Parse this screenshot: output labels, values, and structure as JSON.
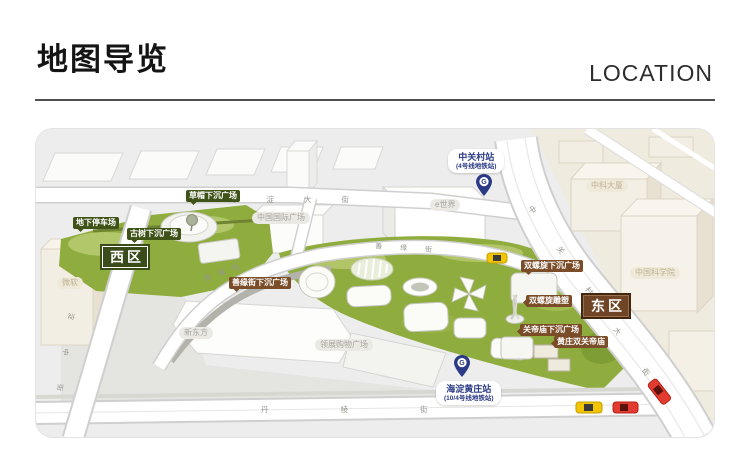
{
  "header": {
    "title_cn": "地图导览",
    "title_en": "LOCATION"
  },
  "map": {
    "zones": {
      "west": "西区",
      "east": "东区"
    },
    "green_labels": {
      "underground_parking": "地下停车场",
      "ancient_tree_plaza": "古树下沉广场",
      "straw_hat_plaza": "草帽下沉广场"
    },
    "brown_labels": {
      "shanyuan_street_plaza": "善缘街下沉广场",
      "double_helix_plaza": "双螺旋下沉广场",
      "double_helix_sculpture": "双螺旋雕塑",
      "guandi_temple_plaza": "关帝庙下沉广场",
      "huangzhuang_temple": "黄庄双关帝庙"
    },
    "stations": {
      "zhongguancun": {
        "name": "中关村站",
        "line": "(4号线地铁站)"
      },
      "haidianhuangzhuang": {
        "name": "海淀黄庄站",
        "line": "(10/4号线地铁站)"
      }
    },
    "buildings": {
      "microsoft": "微软",
      "china_intl_plaza": "中国国际广场",
      "e_world": "e世界",
      "zhongke_tower": "中科大厦",
      "cas": "中国科学院",
      "new_oriental": "新东方",
      "link_plaza": "领展购物广场"
    },
    "roads": {
      "haidian_avenue": "海淀大街",
      "zhongguancun_avenue": "中关村大街",
      "haidian_middle_street": "海淀中街",
      "danling_street": "丹棱街",
      "shanyuan_street": "善缘街"
    },
    "metro_logo_glyph": "G",
    "colors": {
      "green_zone": "#8fac3e",
      "green_label": "#3f5318",
      "brown_label": "#7a4c28",
      "west_badge": "#3a4c1a",
      "east_badge": "#6f4526",
      "station_blue": "#2b3a85",
      "taxi_yellow": "#f2c500",
      "car_red": "#e23b30"
    }
  }
}
